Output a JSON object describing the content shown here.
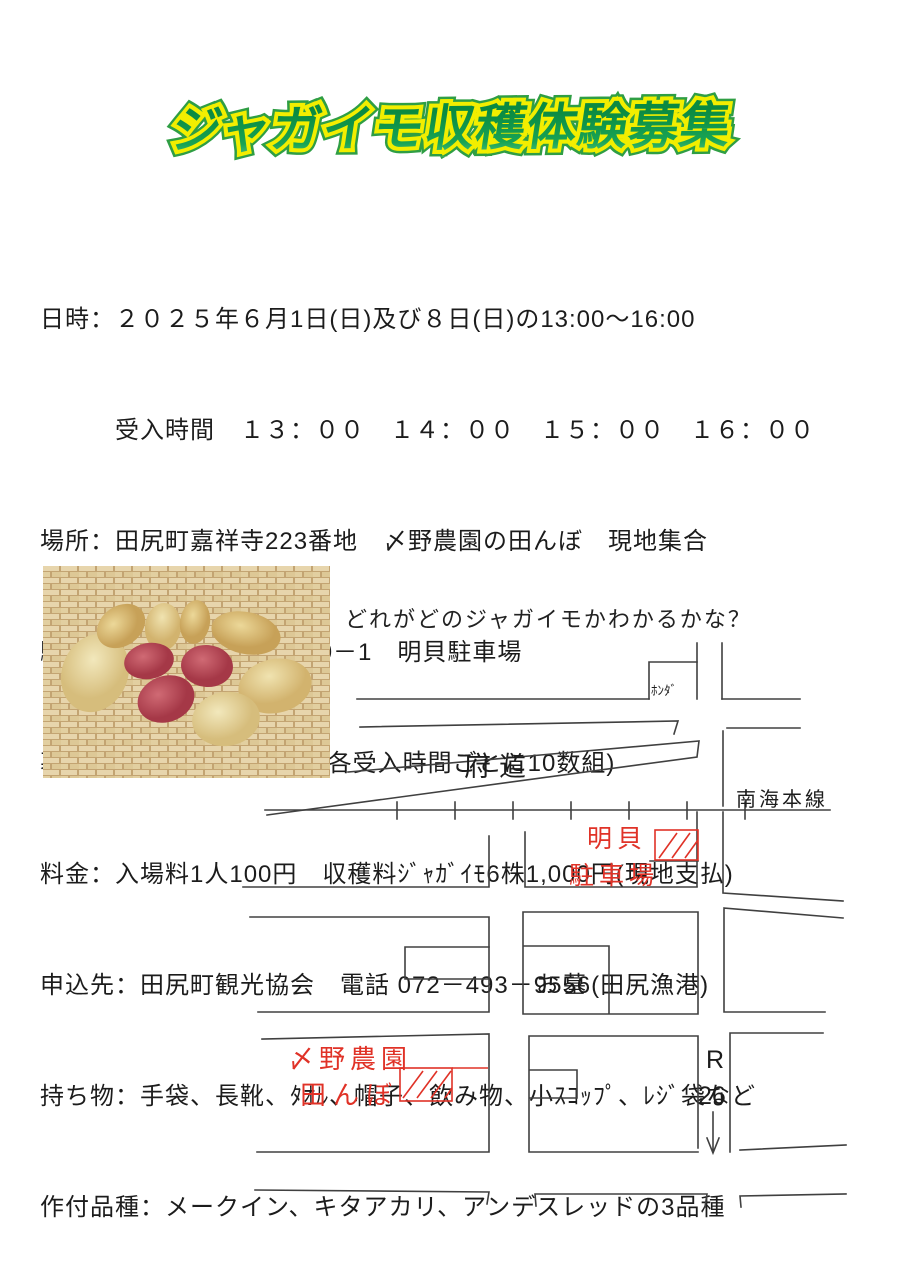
{
  "title": "ジャガイモ収穫体験募集",
  "colors": {
    "title_fill": "#0f9148",
    "title_outline_yellow": "#f2ee00",
    "title_outline_green": "#2f9e44",
    "body_text": "#1c1c1c",
    "map_line": "#404040",
    "map_red": "#e03227"
  },
  "info_lines": [
    "日時：２０２５年６月1日(日)及び８日(日)の13:00～16:00",
    "　　　受入時間　１３：００　１４：００　１５：００　１６：００",
    "場所：田尻町嘉祥寺223番地　〆野農園の田んぼ　現地集合",
    "駐車場：田尻町嘉祥寺540－1　明貝駐車場",
    "募集定員：各日50組まで(各受入時間ごとに10数組)",
    "料金：入場料1人100円　収穫料ｼﾞｬｶﾞｲﾓ6株1,000円(現地支払)",
    "申込先：田尻町観光協会　電話 072－493－9556(田尻漁港)",
    "持ち物：手袋、長靴、ﾀｵﾙ、帽子、飲み物、小ｽｺｯﾌﾟ、ﾚｼﾞ袋など",
    "作付品種：メークイン、キタアカリ、アンデスレッドの3品種"
  ],
  "photo_caption": "どれがどのジャガイモかわかるかな？",
  "map": {
    "labels": {
      "honda": "ﾎﾝﾀﾞ",
      "prefectural_road": "府道",
      "railway": "南海本線",
      "parking_line1": "明貝",
      "parking_line2": "駐車場",
      "grave": "お墓",
      "farm_line1": "〆野農園",
      "farm_line2": "田んぼ",
      "route_letter": "R",
      "route_number": "26"
    }
  }
}
